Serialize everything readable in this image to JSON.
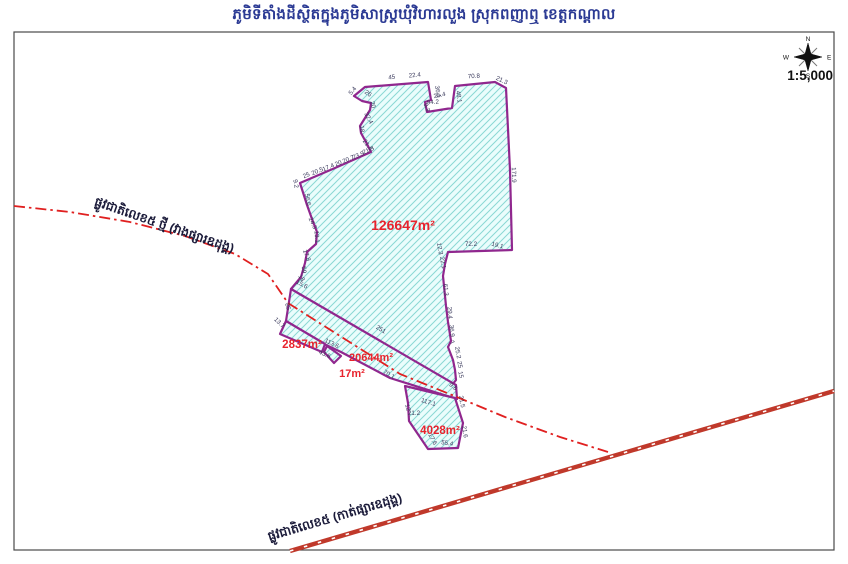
{
  "title": "ភូមិទីតាំងដីស្ថិតក្នុងភូមិសាស្ត្រឃុំវិហារលួង ស្រុកពញាឮ ខេត្តកណ្ដាល",
  "scale_label": "1:5,000",
  "compass": {
    "n": "N",
    "e": "E",
    "s": "S",
    "w": "W"
  },
  "colors": {
    "title": "#2b3a94",
    "frame": "#4a4a4a",
    "parcel_border": "#90278e",
    "parcel_fill": "#eafdfc",
    "hatch": "#8ad8d4",
    "road": "#c0392b",
    "centerline": "#e02020",
    "area_label": "#e8232d",
    "measurement": "#3a3a5c",
    "road_label": "#1b1b3a",
    "compass_icon": "#111111"
  },
  "parcels": [
    {
      "id": "main",
      "area_label": "126647m²",
      "label": {
        "x": 403,
        "y": 230,
        "size": 14
      },
      "points": [
        [
          362,
          101
        ],
        [
          354,
          96
        ],
        [
          365,
          87
        ],
        [
          428,
          82
        ],
        [
          431,
          100
        ],
        [
          425,
          102
        ],
        [
          427,
          112
        ],
        [
          452,
          108
        ],
        [
          455,
          86
        ],
        [
          495,
          82
        ],
        [
          506,
          88
        ],
        [
          510,
          170
        ],
        [
          512,
          250
        ],
        [
          448,
          252
        ],
        [
          445,
          264
        ],
        [
          443,
          276
        ],
        [
          446,
          306
        ],
        [
          448,
          322
        ],
        [
          451,
          341
        ],
        [
          448,
          347
        ],
        [
          453,
          360
        ],
        [
          455,
          370
        ],
        [
          456,
          380
        ],
        [
          452,
          385
        ],
        [
          456,
          388
        ],
        [
          291,
          289
        ],
        [
          301,
          277
        ],
        [
          305,
          263
        ],
        [
          307,
          252
        ],
        [
          316,
          244
        ],
        [
          317,
          232
        ],
        [
          312,
          219
        ],
        [
          307,
          205
        ],
        [
          300,
          183
        ],
        [
          335,
          168
        ],
        [
          371,
          152
        ],
        [
          367,
          144
        ],
        [
          361,
          133
        ],
        [
          360,
          126
        ],
        [
          365,
          118
        ],
        [
          370,
          110
        ],
        [
          371,
          103
        ]
      ]
    },
    {
      "id": "road-strip",
      "area_label": "20644m²",
      "label": {
        "x": 371,
        "y": 361,
        "size": 11
      },
      "points": [
        [
          291,
          289
        ],
        [
          456,
          385
        ],
        [
          457,
          399
        ],
        [
          390,
          378
        ],
        [
          341,
          352
        ],
        [
          322,
          343
        ],
        [
          286,
          321
        ]
      ]
    },
    {
      "id": "west",
      "area_label": "2837m²",
      "label": {
        "x": 302,
        "y": 348,
        "size": 11.5
      },
      "points": [
        [
          286,
          321
        ],
        [
          280,
          334
        ],
        [
          322,
          352
        ],
        [
          325,
          344
        ]
      ]
    },
    {
      "id": "sliver",
      "area_label": "17m²",
      "label": {
        "x": 352,
        "y": 377,
        "size": 11
      },
      "points": [
        [
          327,
          346
        ],
        [
          324,
          352
        ],
        [
          334,
          363
        ],
        [
          341,
          356
        ]
      ]
    },
    {
      "id": "south",
      "area_label": "4028m²",
      "label": {
        "x": 440,
        "y": 434,
        "size": 11.5
      },
      "points": [
        [
          405,
          386
        ],
        [
          455,
          398
        ],
        [
          463,
          423
        ],
        [
          458,
          448
        ],
        [
          428,
          449
        ],
        [
          409,
          421
        ],
        [
          408,
          403
        ]
      ]
    }
  ],
  "roads": [
    {
      "id": "np5-new",
      "label": "ផ្លូវជាតិលេខ៥ ថ្មី (វាងផ្សារឧដុង្គ)",
      "style": "dashdot",
      "label_pos": {
        "x": 163,
        "y": 229,
        "rotate": 19
      },
      "points": [
        [
          14,
          206
        ],
        [
          70,
          212
        ],
        [
          130,
          222
        ],
        [
          185,
          236
        ],
        [
          235,
          254
        ],
        [
          268,
          274
        ],
        [
          288,
          303
        ],
        [
          340,
          336
        ],
        [
          400,
          374
        ],
        [
          452,
          395
        ],
        [
          505,
          417
        ],
        [
          560,
          437
        ],
        [
          608,
          452
        ]
      ]
    },
    {
      "id": "np5-old",
      "label": "ផ្លូវជាតិលេខ៥ (កាត់ផ្សារឧដុង្គ)",
      "style": "double",
      "label_pos": {
        "x": 336,
        "y": 521,
        "rotate": -16.5
      },
      "points": [
        [
          290,
          551
        ],
        [
          834,
          391
        ]
      ]
    }
  ],
  "measurements": [
    {
      "v": "5.4",
      "x": 354,
      "y": 92,
      "r": -50
    },
    {
      "v": "45",
      "x": 392,
      "y": 79,
      "r": -8
    },
    {
      "v": "22.4",
      "x": 415,
      "y": 77,
      "r": -6
    },
    {
      "v": "36.1",
      "x": 436,
      "y": 92,
      "r": 80
    },
    {
      "v": "25.4",
      "x": 440,
      "y": 97,
      "r": -12
    },
    {
      "v": "9.3",
      "x": 425,
      "y": 108,
      "r": 70
    },
    {
      "v": "94.2",
      "x": 433,
      "y": 104,
      "r": -4
    },
    {
      "v": "48.1",
      "x": 457,
      "y": 97,
      "r": 82
    },
    {
      "v": "70.8",
      "x": 474,
      "y": 78,
      "r": -4
    },
    {
      "v": "21.3",
      "x": 501,
      "y": 82,
      "r": 25
    },
    {
      "v": "171.9",
      "x": 512,
      "y": 175,
      "r": 88
    },
    {
      "v": "26",
      "x": 367,
      "y": 95,
      "r": 35
    },
    {
      "v": "20",
      "x": 371,
      "y": 105,
      "r": 78
    },
    {
      "v": "32.4",
      "x": 367,
      "y": 119,
      "r": 62
    },
    {
      "v": "18",
      "x": 360,
      "y": 129,
      "r": 85
    },
    {
      "v": "21.4",
      "x": 366,
      "y": 146,
      "r": 55
    },
    {
      "v": "25",
      "x": 307,
      "y": 177,
      "r": -23
    },
    {
      "v": "20.5",
      "x": 318,
      "y": 173,
      "r": -23
    },
    {
      "v": "17.4",
      "x": 329,
      "y": 169,
      "r": -23
    },
    {
      "v": "20",
      "x": 339,
      "y": 165,
      "r": -23
    },
    {
      "v": "20.7",
      "x": 349,
      "y": 161,
      "r": -23
    },
    {
      "v": "23.9",
      "x": 359,
      "y": 157,
      "r": -23
    },
    {
      "v": "21.3",
      "x": 369,
      "y": 152,
      "r": -23
    },
    {
      "v": "9.2",
      "x": 294,
      "y": 184,
      "r": 80
    },
    {
      "v": "56.6",
      "x": 306,
      "y": 200,
      "r": 80
    },
    {
      "v": "24.3",
      "x": 311,
      "y": 224,
      "r": 65
    },
    {
      "v": "13.1",
      "x": 315,
      "y": 237,
      "r": 85
    },
    {
      "v": "17.8",
      "x": 305,
      "y": 256,
      "r": 70
    },
    {
      "v": "59",
      "x": 302,
      "y": 270,
      "r": 85
    },
    {
      "v": "18",
      "x": 300,
      "y": 279,
      "r": 55
    },
    {
      "v": "72.2",
      "x": 471,
      "y": 246,
      "r": 0
    },
    {
      "v": "19.1",
      "x": 497,
      "y": 247,
      "r": 15
    },
    {
      "v": "12.3",
      "x": 438,
      "y": 249,
      "r": 80
    },
    {
      "v": "22.1",
      "x": 441,
      "y": 263,
      "r": 80
    },
    {
      "v": "61.3",
      "x": 444,
      "y": 290,
      "r": 85
    },
    {
      "v": "29.4",
      "x": 448,
      "y": 313,
      "r": 85
    },
    {
      "v": "36.9",
      "x": 450,
      "y": 331,
      "r": 85
    },
    {
      "v": "7",
      "x": 451,
      "y": 344,
      "r": 40
    },
    {
      "v": "25.2",
      "x": 456,
      "y": 353,
      "r": 80
    },
    {
      "v": "25",
      "x": 458,
      "y": 365,
      "r": 80
    },
    {
      "v": "15",
      "x": 459,
      "y": 375,
      "r": 80
    },
    {
      "v": "9.6",
      "x": 452,
      "y": 388,
      "r": 40
    },
    {
      "v": "15.6",
      "x": 301,
      "y": 286,
      "r": 28
    },
    {
      "v": "85",
      "x": 286,
      "y": 307,
      "r": 75
    },
    {
      "v": "13.7",
      "x": 278,
      "y": 324,
      "r": 45
    },
    {
      "v": "113.6",
      "x": 331,
      "y": 345,
      "r": 26
    },
    {
      "v": "43.6",
      "x": 324,
      "y": 356,
      "r": 22
    },
    {
      "v": "251",
      "x": 380,
      "y": 331,
      "r": 31
    },
    {
      "v": "70.1",
      "x": 388,
      "y": 376,
      "r": 30
    },
    {
      "v": "117.1",
      "x": 428,
      "y": 404,
      "r": 16
    },
    {
      "v": "12",
      "x": 406,
      "y": 408,
      "r": 75
    },
    {
      "v": "21.2",
      "x": 414,
      "y": 415,
      "r": 0
    },
    {
      "v": "17.6",
      "x": 431,
      "y": 440,
      "r": 62
    },
    {
      "v": "55.4",
      "x": 447,
      "y": 445,
      "r": 8
    },
    {
      "v": "21.6",
      "x": 463,
      "y": 432,
      "r": 82
    },
    {
      "v": "21.5",
      "x": 460,
      "y": 402,
      "r": 80
    }
  ]
}
